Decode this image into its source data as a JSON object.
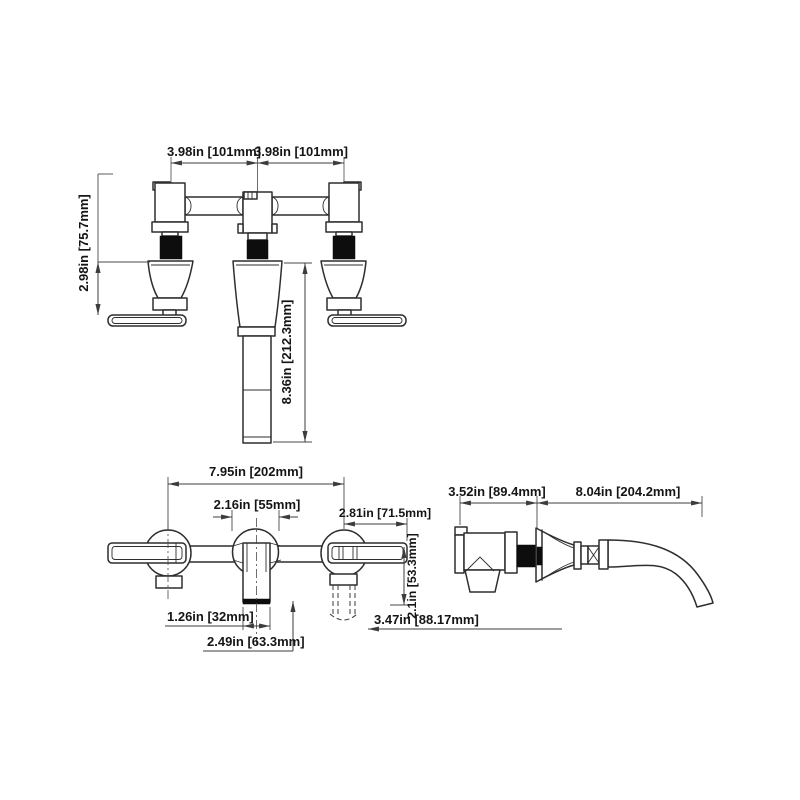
{
  "drawing": {
    "title": "wall-mount widespread faucet dimension drawing",
    "units": "inches [millimetres]",
    "colors": {
      "background": "#ffffff",
      "line": "#2e2e2e",
      "dimension_line": "#3c3c3c",
      "text": "#151515",
      "solid_fill": "#0d0d0d"
    },
    "views": {
      "front": {
        "name": "front elevation",
        "dims": [
          {
            "id": "handle-spacing-left",
            "label": "3.98in [101mm]"
          },
          {
            "id": "handle-spacing-right",
            "label": "3.98in [101mm]"
          },
          {
            "id": "handle-protrusion",
            "label": "2.98in [75.7mm]"
          },
          {
            "id": "spout-drop",
            "label": "8.36in [212.3mm]"
          }
        ]
      },
      "plan": {
        "name": "top plan",
        "dims": [
          {
            "id": "overall-width",
            "label": "7.95in [202mm]"
          },
          {
            "id": "center-flange-width",
            "label": "2.16in [55mm]"
          },
          {
            "id": "handle-length",
            "label": "2.81in [71.5mm]"
          },
          {
            "id": "handle-clearance",
            "label": "2.1in [53.3mm]"
          },
          {
            "id": "spout-tube-width",
            "label": "1.26in [32mm]"
          },
          {
            "id": "spout-base-width",
            "label": "2.49in [63.3mm]"
          },
          {
            "id": "handle-swing-clearance",
            "label": "3.47in [88.17mm]"
          }
        ]
      },
      "side": {
        "name": "side profile",
        "dims": [
          {
            "id": "rough-in-depth",
            "label": "3.52in [89.4mm]"
          },
          {
            "id": "spout-reach",
            "label": "8.04in [204.2mm]"
          }
        ]
      }
    }
  }
}
